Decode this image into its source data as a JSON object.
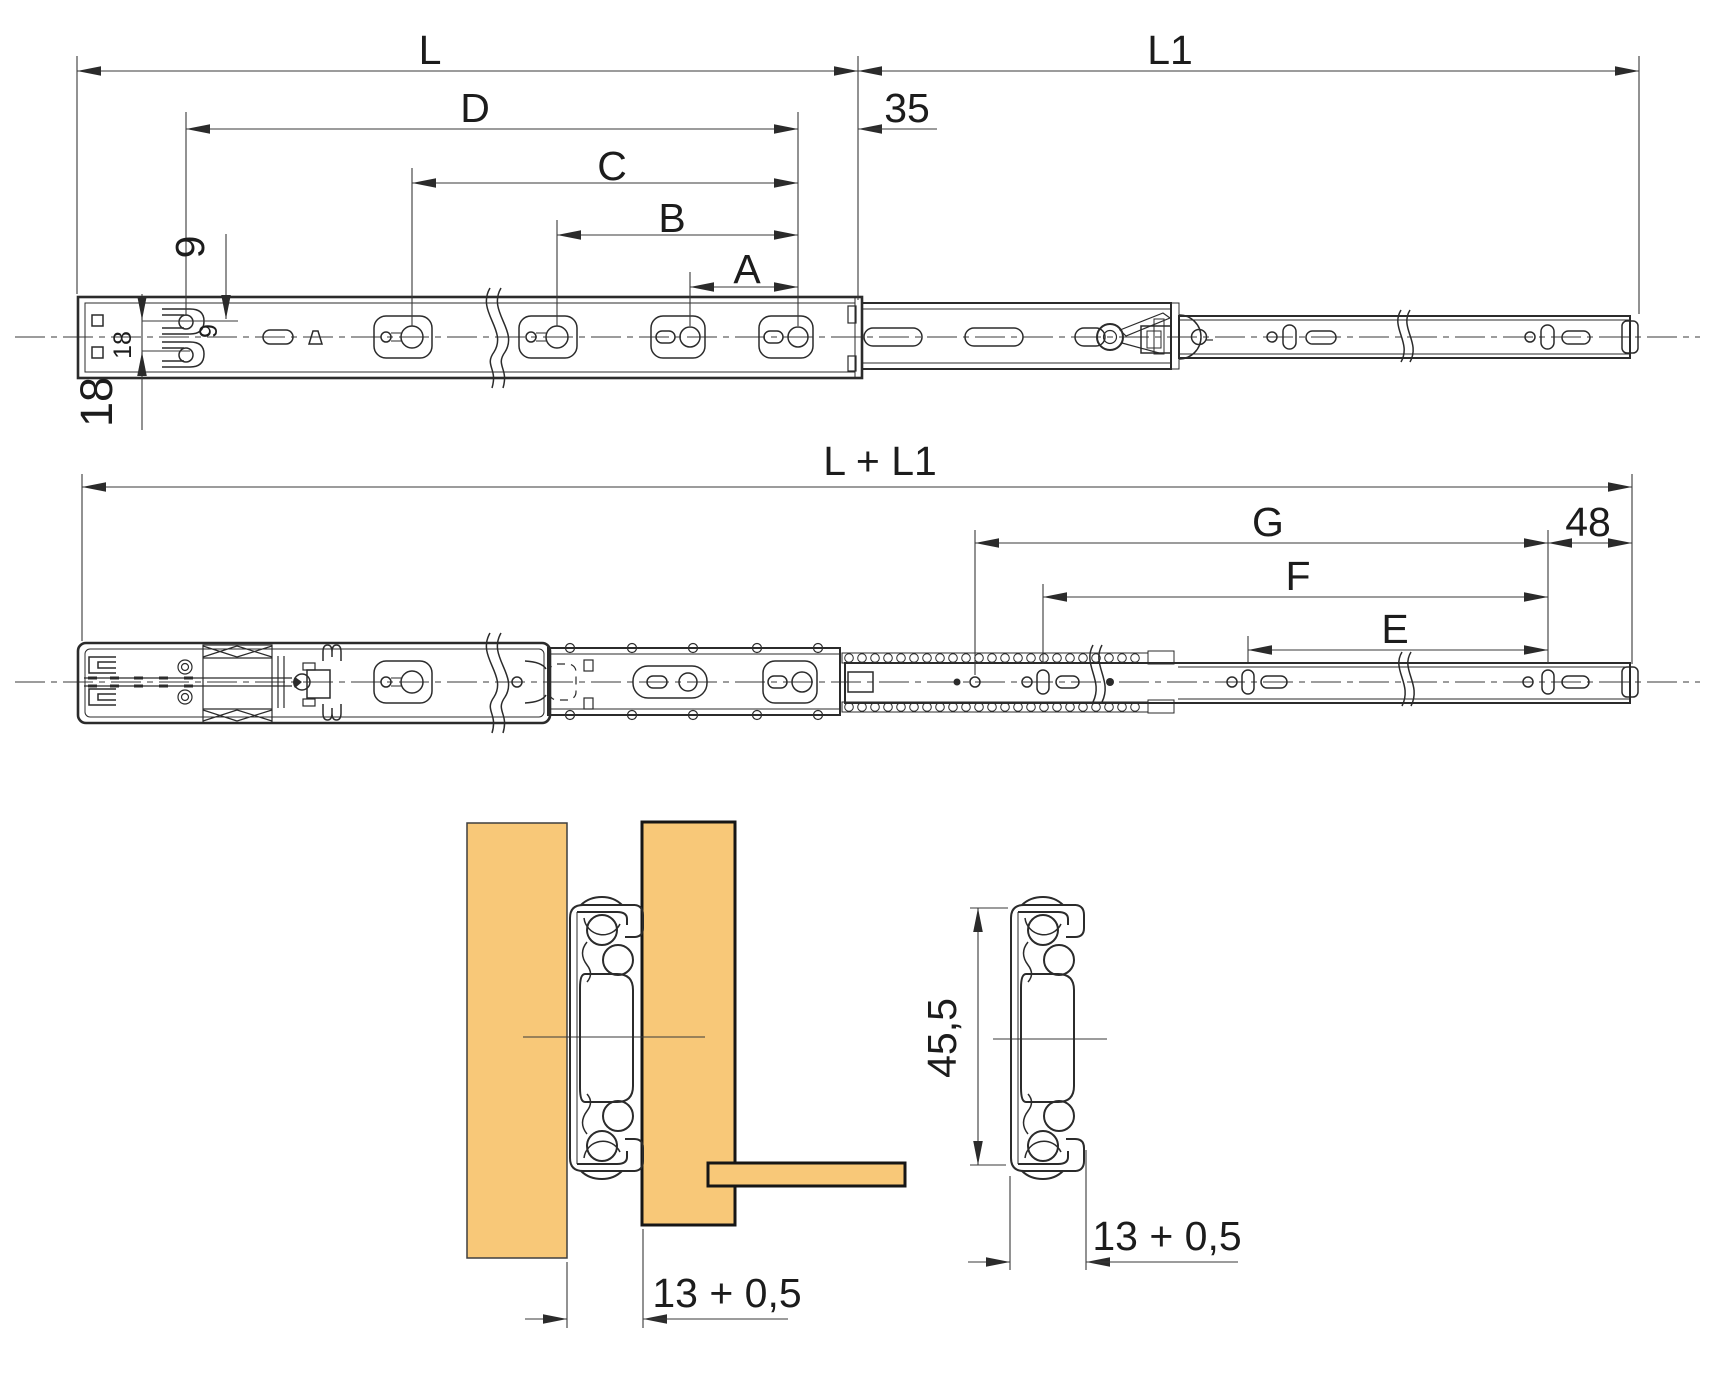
{
  "figure": {
    "type": "technical-drawing",
    "subject": "ball-bearing telescopic drawer slide: closed side view, fully extended side view, mounted cross-section between panels, profile cross-section",
    "colors": {
      "background": "#ffffff",
      "line": "#2b2b2b",
      "dimension_line": "#3a3a3a",
      "wood_fill": "#f8c878",
      "wood_edge": "#161616"
    }
  },
  "dims": {
    "closed": {
      "L": "L",
      "L1": "L1",
      "D": "D",
      "C": "C",
      "B": "B",
      "A": "A",
      "front_hole_offset": "35",
      "row_offset": "9",
      "row_offset_inner": "9",
      "row_spacing_inner": "18",
      "row_spacing_outer": "18"
    },
    "extended": {
      "total": "L + L1",
      "G": "G",
      "F": "F",
      "E": "E",
      "front_hole_offset": "48"
    },
    "installation": {
      "panel_gap": "13 + 0,5"
    },
    "profile": {
      "height": "45,5",
      "width": "13 + 0,5"
    }
  }
}
